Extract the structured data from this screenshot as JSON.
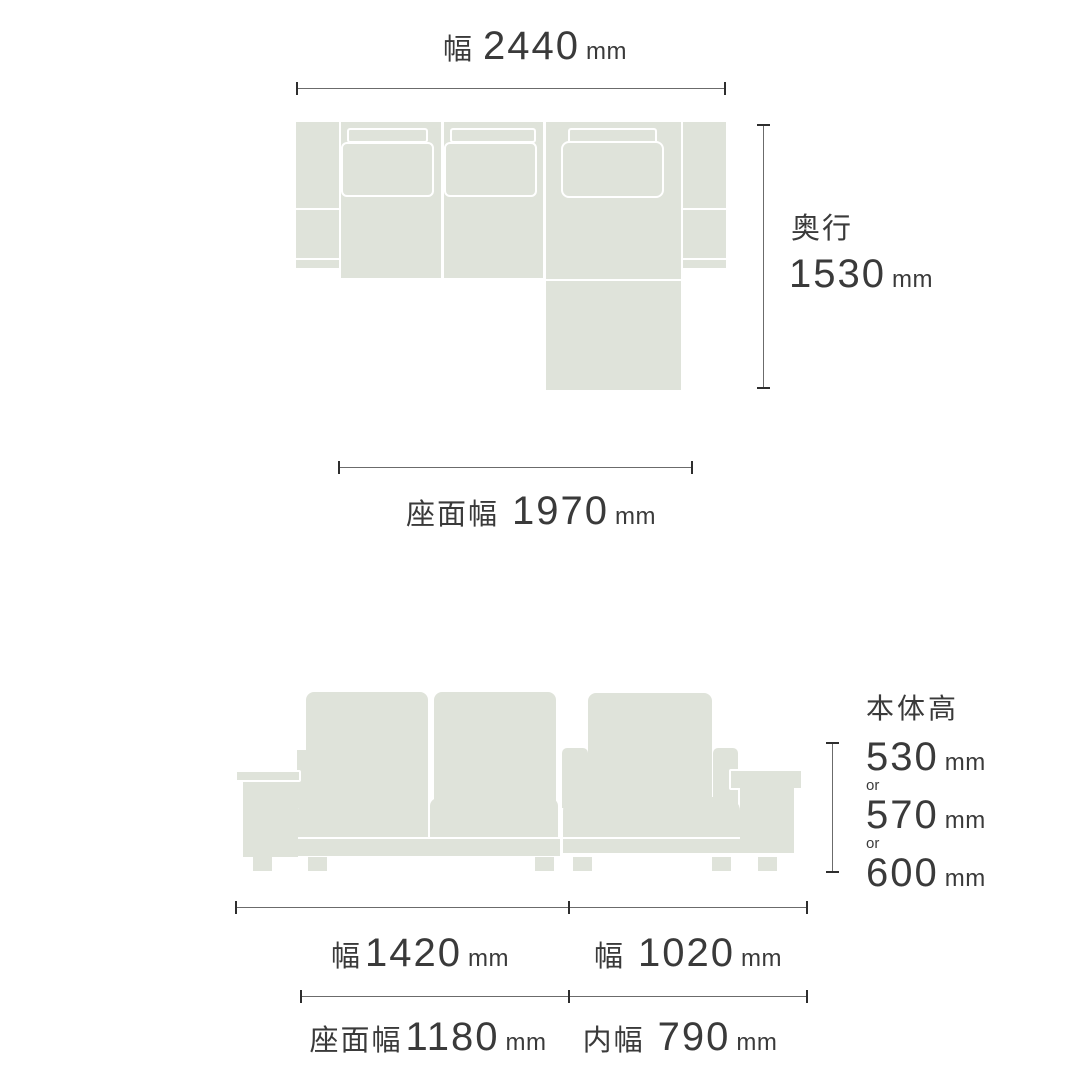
{
  "colors": {
    "sofa_fill": "#dfe3da",
    "outline": "#ffffff",
    "dim_line": "#6b6b6b",
    "dim_tick": "#2e2e2e",
    "text": "#3a3a3a"
  },
  "top_view": {
    "width": {
      "label": "幅",
      "value": "2440",
      "unit": "mm"
    },
    "depth": {
      "label": "奥行",
      "value": "1530",
      "unit": "mm"
    },
    "seat_width": {
      "label": "座面幅",
      "value": "1970",
      "unit": "mm"
    }
  },
  "front_view": {
    "body_height": {
      "label": "本体高",
      "or": "or",
      "options": [
        {
          "value": "530",
          "unit": "mm"
        },
        {
          "value": "570",
          "unit": "mm"
        },
        {
          "value": "600",
          "unit": "mm"
        }
      ]
    },
    "left_width": {
      "label": "幅",
      "value": "1420",
      "unit": "mm"
    },
    "right_width": {
      "label": "幅",
      "value": "1020",
      "unit": "mm"
    },
    "seat_width": {
      "label": "座面幅",
      "value": "1180",
      "unit": "mm"
    },
    "inner_width": {
      "label": "内幅",
      "value": "790",
      "unit": "mm"
    }
  }
}
